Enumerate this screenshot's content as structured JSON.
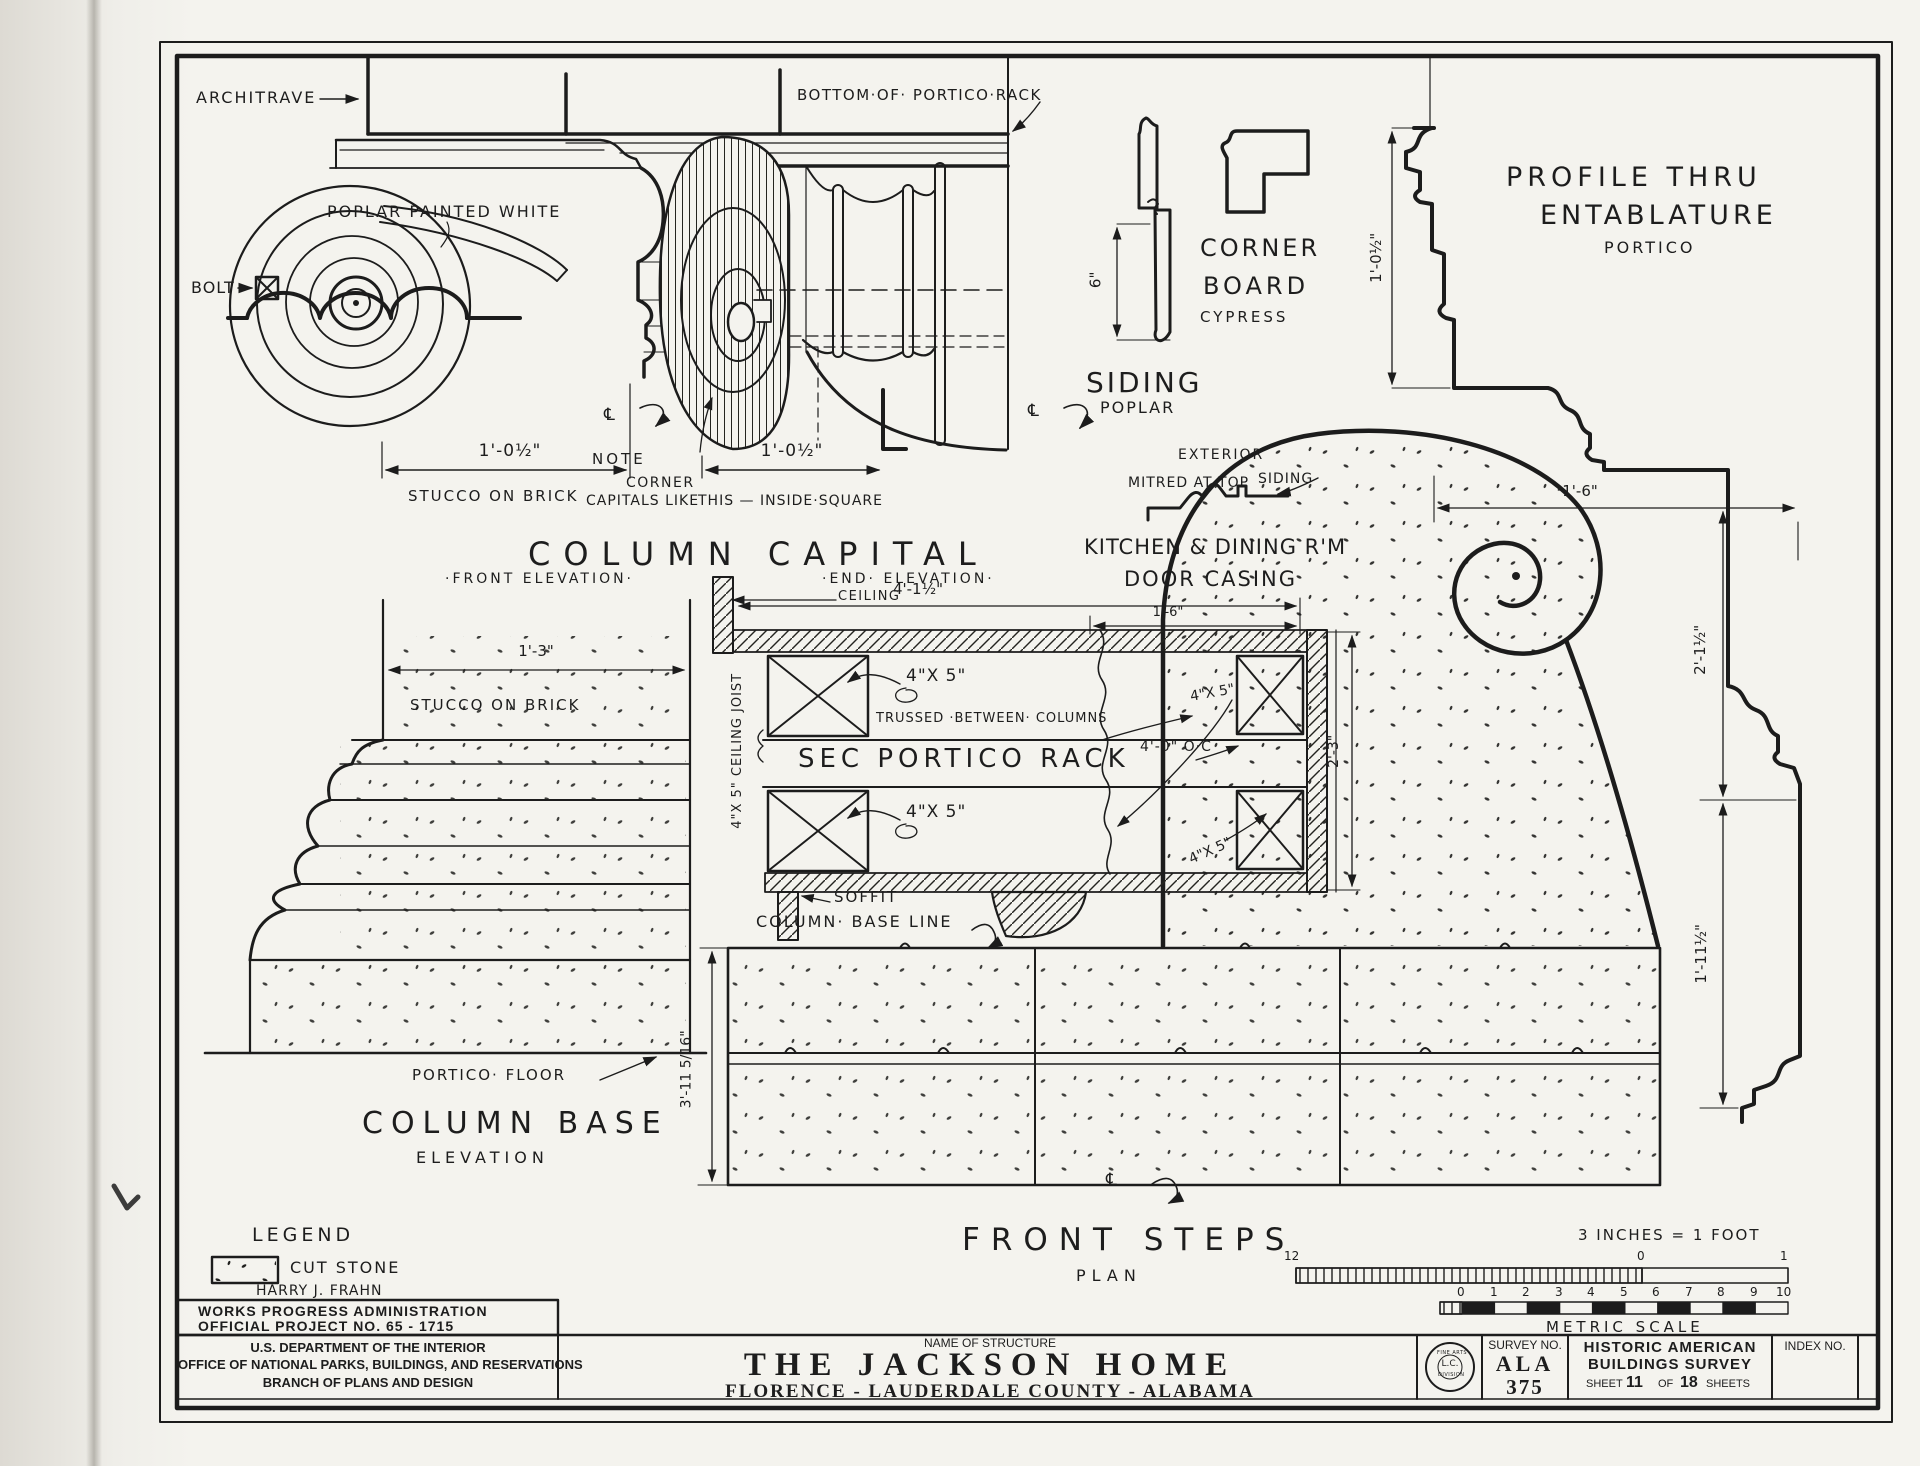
{
  "colors": {
    "ink": "#1c1c1c",
    "paper": "#f4f3ee"
  },
  "labels": {
    "architrave": "ARCHITRAVE",
    "poplar_painted_white": "POPLAR PAINTED WHITE",
    "bolt": "BOLT",
    "dim_capital_front": "1'-0½\"",
    "stucco_on_brick_capital": "STUCCO ON BRICK",
    "bottom_of_portico_rack": "BOTTOM·OF· PORTICO·RACK",
    "note_line1": "NOTE",
    "note_line2": "CORNER",
    "note_line3": "CAPITALS LIKE",
    "note_line4": "THIS — INSIDE·SQUARE",
    "dim_capital_end": "1'-0½\"",
    "title_column_capital": "COLUMN  CAPITAL",
    "sub_front_elevation": "·FRONT  ELEVATION·",
    "sub_end_elevation": "·END·  ELEVATION·",
    "ceiling": "CEILING",
    "dim_rack_width": "4'-1½\"",
    "corner_board_1": "CORNER",
    "corner_board_2": "BOARD",
    "corner_board_3": "CYPRESS",
    "dim_siding": "6\"",
    "siding_big": "SIDING",
    "poplar": "POPLAR",
    "exterior": "EXTERIOR",
    "mitred_at_top": "MITRED AT TOP",
    "siding_small": "SIDING",
    "profile_title_1": "PROFILE  THRU",
    "profile_title_2": "ENTABLATURE",
    "profile_title_3": "PORTICO",
    "dim_profile_height": "1'-0½\"",
    "dim_profile_width": "1'-6\"",
    "dim_profile_upper": "2'-1½\"",
    "dim_profile_lower": "1'-11½\"",
    "kitchen_dining": "KITCHEN & DINING R'M",
    "door_casing": "DOOR CASING",
    "dim_casing_width": "1'-6\"",
    "dim_casing_height": "2'-3\"",
    "joist_1": "4\"X 5\"",
    "joist_2": "4\"X 5\"",
    "joist_3": "4\"X 5\"",
    "joist_4": "4\"X 5\"",
    "trussed": "TRUSSED ·BETWEEN· COLUMNS",
    "sec_portico_rack": "SEC  PORTICO  RACK",
    "dim_oc": "4'-0\"  O·C",
    "ceiling_joist_vert": "4\"X 5\"  CEILING  JOIST",
    "soffit": "SOFFIT",
    "column_base_line": "COLUMN· BASE  LINE",
    "dim_base_width": "1'-3\"",
    "stucco_on_brick_base": "STUCCO  ON  BRICK",
    "portico_floor": "PORTICO·  FLOOR",
    "title_column_base": "COLUMN  BASE",
    "sub_elevation": "ELEVATION",
    "dim_steps": "3'-11 5/16\"",
    "title_front_steps": "FRONT  STEPS",
    "sub_plan": "PLAN",
    "scale_note": "3 INCHES = 1 FOOT",
    "scale_12": "12",
    "scale_0": "0",
    "scale_1": "1",
    "metric_numbers": [
      "0",
      "1",
      "2",
      "3",
      "4",
      "5",
      "6",
      "7",
      "8",
      "9",
      "10"
    ],
    "metric_scale": "METRIC  SCALE",
    "legend_title": "LEGEND",
    "legend_cut_stone": "CUT  STONE",
    "legend_author": "HARRY  J.  FRAHN",
    "centerline_symbol": "℄"
  },
  "title_block": {
    "wpa_line1": "WORKS  PROGRESS  ADMINISTRATION",
    "wpa_line2": "OFFICIAL  PROJECT  NO. 65 - 1715",
    "dept_line1": "U.S. DEPARTMENT OF THE INTERIOR",
    "dept_line2": "OFFICE OF NATIONAL PARKS, BUILDINGS, AND RESERVATIONS",
    "dept_line3": "BRANCH OF PLANS AND DESIGN",
    "name_of_structure_label": "NAME OF STRUCTURE",
    "structure_name": "THE  JACKSON  HOME",
    "structure_location": "FLORENCE - LAUDERDALE  COUNTY - ALABAMA",
    "survey_label": "SURVEY NO.",
    "survey_no_line1": "ALA",
    "survey_no_line2": "375",
    "habs_line1": "HISTORIC  AMERICAN",
    "habs_line2": "BUILDINGS  SURVEY",
    "sheet_prefix": "SHEET",
    "sheet_no": "11",
    "sheet_mid": "OF",
    "sheet_total": "18",
    "sheet_suffix": "SHEETS",
    "index_label": "INDEX NO.",
    "stamp_top": "FINE ARTS",
    "stamp_mid": "L.C.",
    "stamp_bottom": "DIVISION"
  }
}
